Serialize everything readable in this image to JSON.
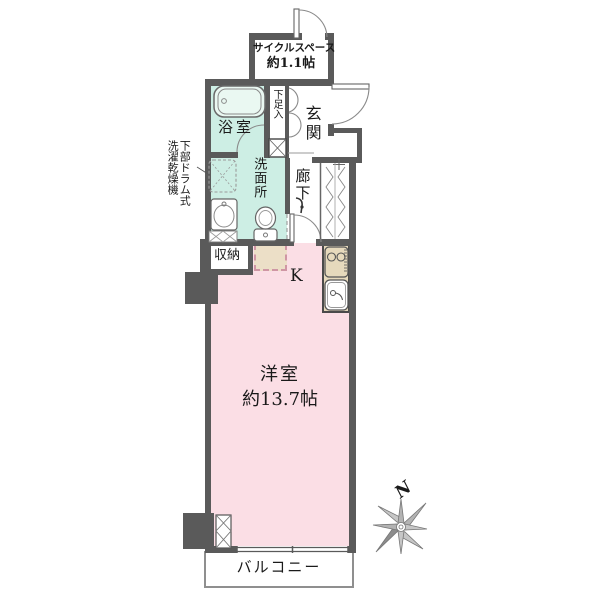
{
  "plan": {
    "rooms": {
      "cycle_space": {
        "label": "サイクルスペース",
        "size": "約1.1帖"
      },
      "bathroom": {
        "label": "浴室"
      },
      "shoe_box": {
        "label": "下足入"
      },
      "entrance": {
        "label": "玄関"
      },
      "hallway": {
        "label": "廊下"
      },
      "washroom": {
        "label": "洗面所"
      },
      "storage": {
        "label": "収納"
      },
      "kitchen": {
        "label": "K"
      },
      "main_room": {
        "label": "洋室",
        "size": "約13.7帖"
      },
      "balcony": {
        "label": "バルコニー"
      }
    },
    "annotations": {
      "laundry_col1": "下部ドラム式",
      "laundry_col2": "洗濯乾燥機"
    },
    "compass": {
      "north": "N"
    },
    "colors": {
      "wall": "#5a5a5a",
      "wet_area": "#cdeee4",
      "room_pink": "#fbdee5",
      "counter_beige": "#e6d9bc",
      "fridge_beige": "#ecdfc7",
      "balcony_border": "#8f8f8f"
    }
  }
}
